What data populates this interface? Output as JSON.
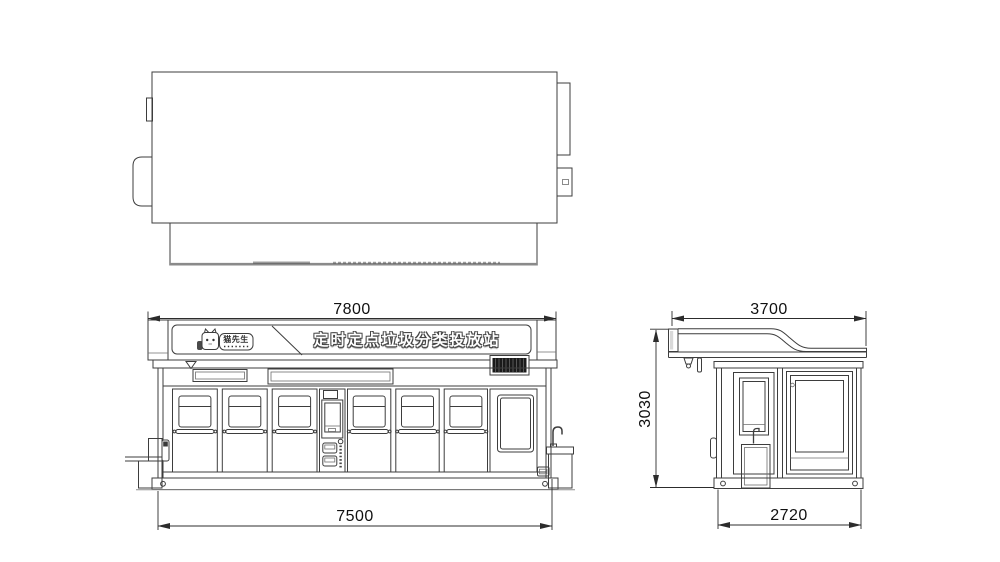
{
  "drawing": {
    "banner": {
      "station_title": "定时定点垃圾分类投放站",
      "logo_text": "猫先生"
    },
    "dimensions": {
      "front_roof_width": "7800",
      "front_body_width": "7500",
      "side_roof_depth": "3700",
      "side_height": "3030",
      "side_body_depth": "2720"
    },
    "colors": {
      "line": "#3d3d3d",
      "dimension": "#2c2c2c",
      "grille": "#1a1a1a",
      "background": "#ffffff"
    }
  }
}
